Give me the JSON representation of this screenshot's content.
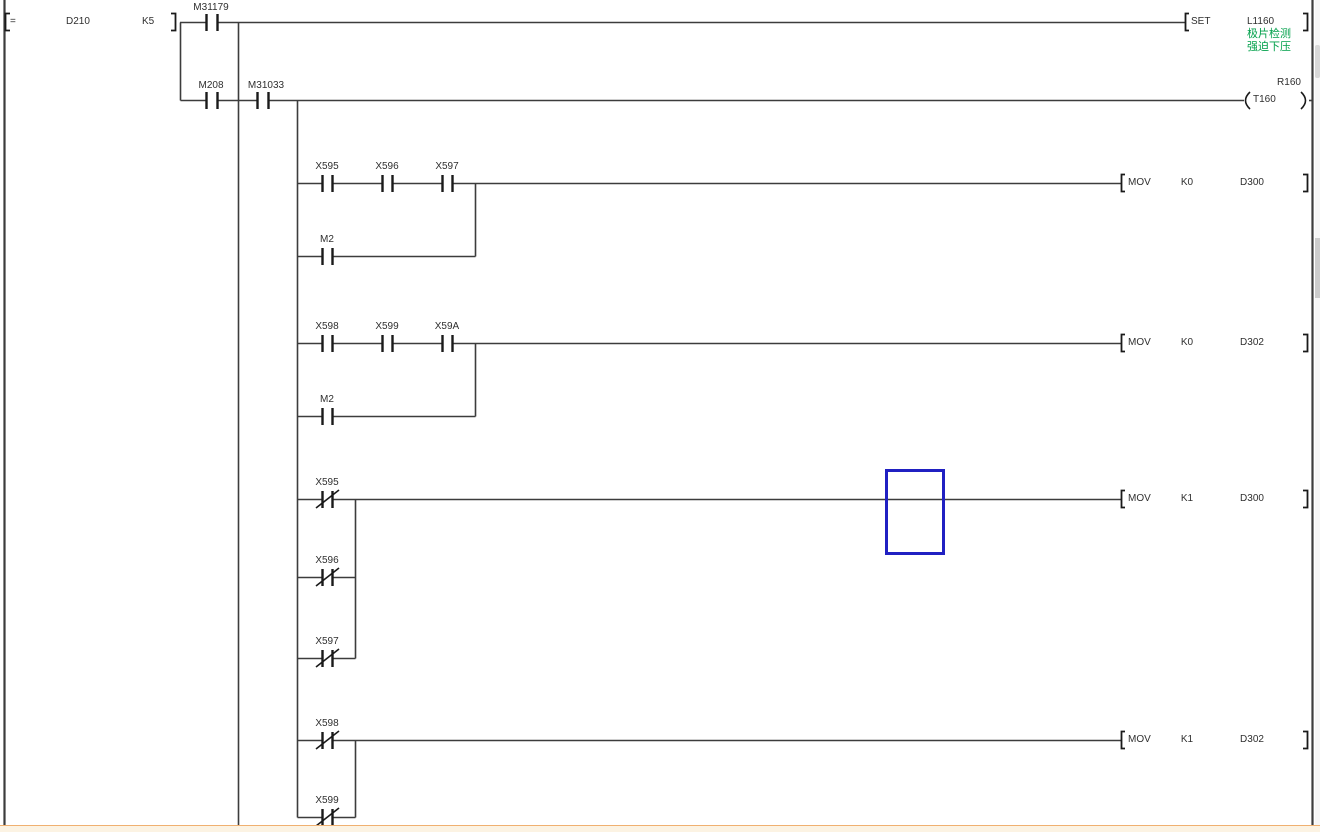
{
  "app": {
    "view": "plc-ladder-editor"
  },
  "colors": {
    "wire": "#3c3c3c",
    "text": "#2f2f2f",
    "comment_green": "#00a04a",
    "selection_cursor_blue": "#2020c2",
    "bottom_strip": "#fcf3e3",
    "bottom_strip_border": "#f0b070"
  },
  "ladder": {
    "rung1": {
      "op": "=",
      "arg1": "D210",
      "arg2": "K5",
      "contact": "M31179",
      "instr": "SET",
      "operand": "L1160",
      "comment1": "极片检测",
      "comment2": "强迫下压"
    },
    "rung2": {
      "contact1": "M208",
      "contact2": "M31033",
      "coil_comment": "R160",
      "coil": "T160"
    },
    "rung3": {
      "contact1": "X595",
      "contact2": "X596",
      "contact3": "X597",
      "parallel": "M2",
      "instr": "MOV",
      "src": "K0",
      "dst": "D300"
    },
    "rung4": {
      "contact1": "X598",
      "contact2": "X599",
      "contact3": "X59A",
      "parallel": "M2",
      "instr": "MOV",
      "src": "K0",
      "dst": "D302"
    },
    "rung5": {
      "contact1": "X595",
      "contact2": "X596",
      "contact3": "X597",
      "instr": "MOV",
      "src": "K1",
      "dst": "D300"
    },
    "rung6": {
      "contact1": "X598",
      "contact2": "X599",
      "instr": "MOV",
      "src": "K1",
      "dst": "D302"
    }
  }
}
